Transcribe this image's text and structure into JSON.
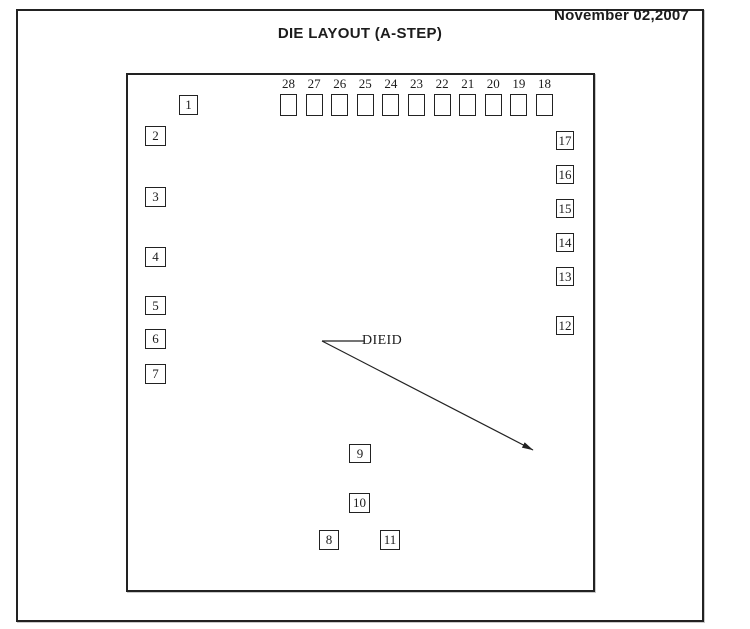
{
  "header": {
    "date": "November 02,2007",
    "title": "DIE LAYOUT (A-STEP)"
  },
  "die": {
    "dieid_label": "DIEID",
    "top_row": [
      {
        "label": "28",
        "x": 280
      },
      {
        "label": "27",
        "x": 305.6
      },
      {
        "label": "26",
        "x": 331.2
      },
      {
        "label": "25",
        "x": 356.8
      },
      {
        "label": "24",
        "x": 382.4
      },
      {
        "label": "23",
        "x": 408
      },
      {
        "label": "22",
        "x": 433.6
      },
      {
        "label": "21",
        "x": 459.2
      },
      {
        "label": "20",
        "x": 484.8
      },
      {
        "label": "19",
        "x": 510.4
      },
      {
        "label": "18",
        "x": 536
      }
    ],
    "pads": [
      {
        "label": "1",
        "x": 179,
        "y": 95,
        "w": 19,
        "h": 20
      },
      {
        "label": "2",
        "x": 145,
        "y": 126,
        "w": 21,
        "h": 20
      },
      {
        "label": "3",
        "x": 145,
        "y": 187,
        "w": 21,
        "h": 20
      },
      {
        "label": "4",
        "x": 145,
        "y": 247,
        "w": 21,
        "h": 20
      },
      {
        "label": "5",
        "x": 145,
        "y": 296,
        "w": 21,
        "h": 19
      },
      {
        "label": "6",
        "x": 145,
        "y": 329,
        "w": 21,
        "h": 20
      },
      {
        "label": "7",
        "x": 145,
        "y": 364,
        "w": 21,
        "h": 20
      },
      {
        "label": "8",
        "x": 319,
        "y": 530,
        "w": 20,
        "h": 20
      },
      {
        "label": "9",
        "x": 349,
        "y": 444,
        "w": 22,
        "h": 19
      },
      {
        "label": "10",
        "x": 349,
        "y": 493,
        "w": 21,
        "h": 20
      },
      {
        "label": "11",
        "x": 380,
        "y": 530,
        "w": 20,
        "h": 20
      },
      {
        "label": "12",
        "x": 556,
        "y": 316,
        "w": 18,
        "h": 19
      },
      {
        "label": "13",
        "x": 556,
        "y": 267,
        "w": 18,
        "h": 19
      },
      {
        "label": "14",
        "x": 556,
        "y": 233,
        "w": 18,
        "h": 19
      },
      {
        "label": "15",
        "x": 556,
        "y": 199,
        "w": 18,
        "h": 19
      },
      {
        "label": "16",
        "x": 556,
        "y": 165,
        "w": 18,
        "h": 19
      },
      {
        "label": "17",
        "x": 556,
        "y": 131,
        "w": 18,
        "h": 19
      }
    ]
  },
  "arrow": {
    "vertex": {
      "x": 322,
      "y": 341
    },
    "label_end": {
      "x": 364,
      "y": 341
    },
    "tip": {
      "x": 533,
      "y": 450
    }
  },
  "colors": {
    "ink": "#1c1c1c",
    "line": "#222222",
    "background": "#ffffff"
  }
}
